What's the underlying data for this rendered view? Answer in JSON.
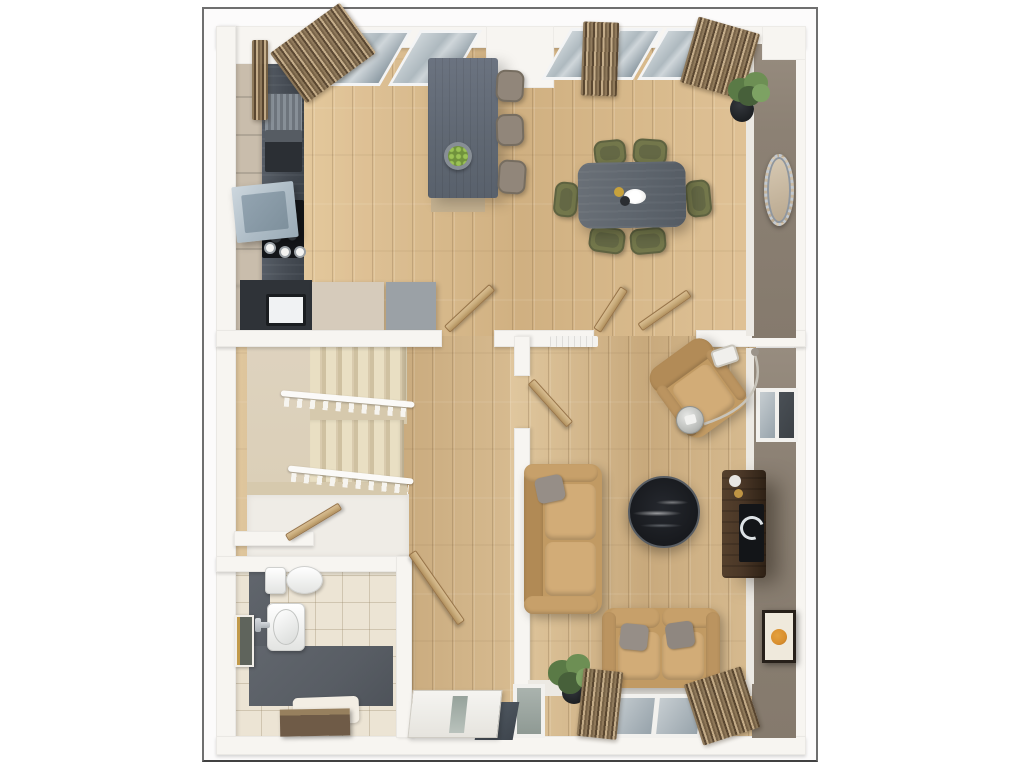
{
  "scene": {
    "kind": "3d-floor-plan-render",
    "view": "top-down",
    "floor": "ground-floor",
    "rooms": [
      {
        "id": "kitchen-dining",
        "label": "Kitchen / Dining",
        "items": [
          "wall-cabinets",
          "counter-run",
          "dish-rack",
          "coffee-machine",
          "extractor-hood",
          "hob",
          "canisters",
          "oven",
          "base-units",
          "kitchen-island",
          "fruit-bowl",
          "bar-stools",
          "dining-table",
          "dining-chairs",
          "place-setting",
          "pot-plant",
          "oval-mirror",
          "windows",
          "striped-curtains"
        ]
      },
      {
        "id": "hallway",
        "label": "Hallway",
        "items": [
          "staircase-two-flights",
          "white-balustrades",
          "understairs-cupboard",
          "cupboard-door",
          "vestibule-door",
          "front-door-with-glazing",
          "doormat",
          "side-light-window"
        ]
      },
      {
        "id": "cloakroom",
        "label": "Cloakroom WC",
        "items": [
          "wall-hung-toilet",
          "hand-basin",
          "chrome-tap",
          "wall-frame",
          "slate-floor-strip",
          "tiled-floor",
          "rug",
          "bath-mat"
        ]
      },
      {
        "id": "living-room",
        "label": "Living Room",
        "items": [
          "armchair",
          "arc-floor-lamp",
          "side-table",
          "three-seat-sofa",
          "two-seat-sofa",
          "throw-pillows",
          "round-marble-coffee-table",
          "walnut-media-console",
          "decor-bowls",
          "speaker-ring",
          "orange-circle-artwork",
          "side-wall-window",
          "rear-window",
          "striped-curtains",
          "pot-plant",
          "radiator"
        ]
      }
    ],
    "counts": {
      "dining_chairs": 6,
      "bar_stools": 3,
      "sofas": 2,
      "open_doors": 6,
      "windows": 5,
      "curtain_panels": 6
    }
  },
  "palette": {
    "frame_border": "#6f6f6f",
    "wood": "#d7bb90",
    "wood_hi": "#e0c79e",
    "wood_lo": "#c8a97c",
    "wall": "#f7f5f1",
    "taupe": "#8c8174",
    "counter": "#4d545d",
    "island": "#5f6772",
    "cabinet": "#c9bdac",
    "stairs": "#dbcfb8",
    "tread_hi": "#e9dfc3",
    "tread_lo": "#cfc1a1",
    "slate": "#585d64",
    "tile": "#ece4d4",
    "tan": "#c19a63",
    "tan_hi": "#d2ac77",
    "olive": "#73774b",
    "olive_dark": "#5e6240",
    "table": "#5f666e",
    "marble": "#17191d",
    "walnut": "#4a3727",
    "walnut_dark": "#2e2115",
    "curtain_a": "#8d7758",
    "curtain_b": "#57442e",
    "curtain_c": "#c3ab87",
    "glass": "#aeb9bf",
    "glass_dark": "#8b99a2",
    "green": "#66854d",
    "door_wood": "#c9ac7c",
    "gold": "#c09544",
    "orange": "#d98f2e",
    "mat_brown": "#6f5b47"
  }
}
